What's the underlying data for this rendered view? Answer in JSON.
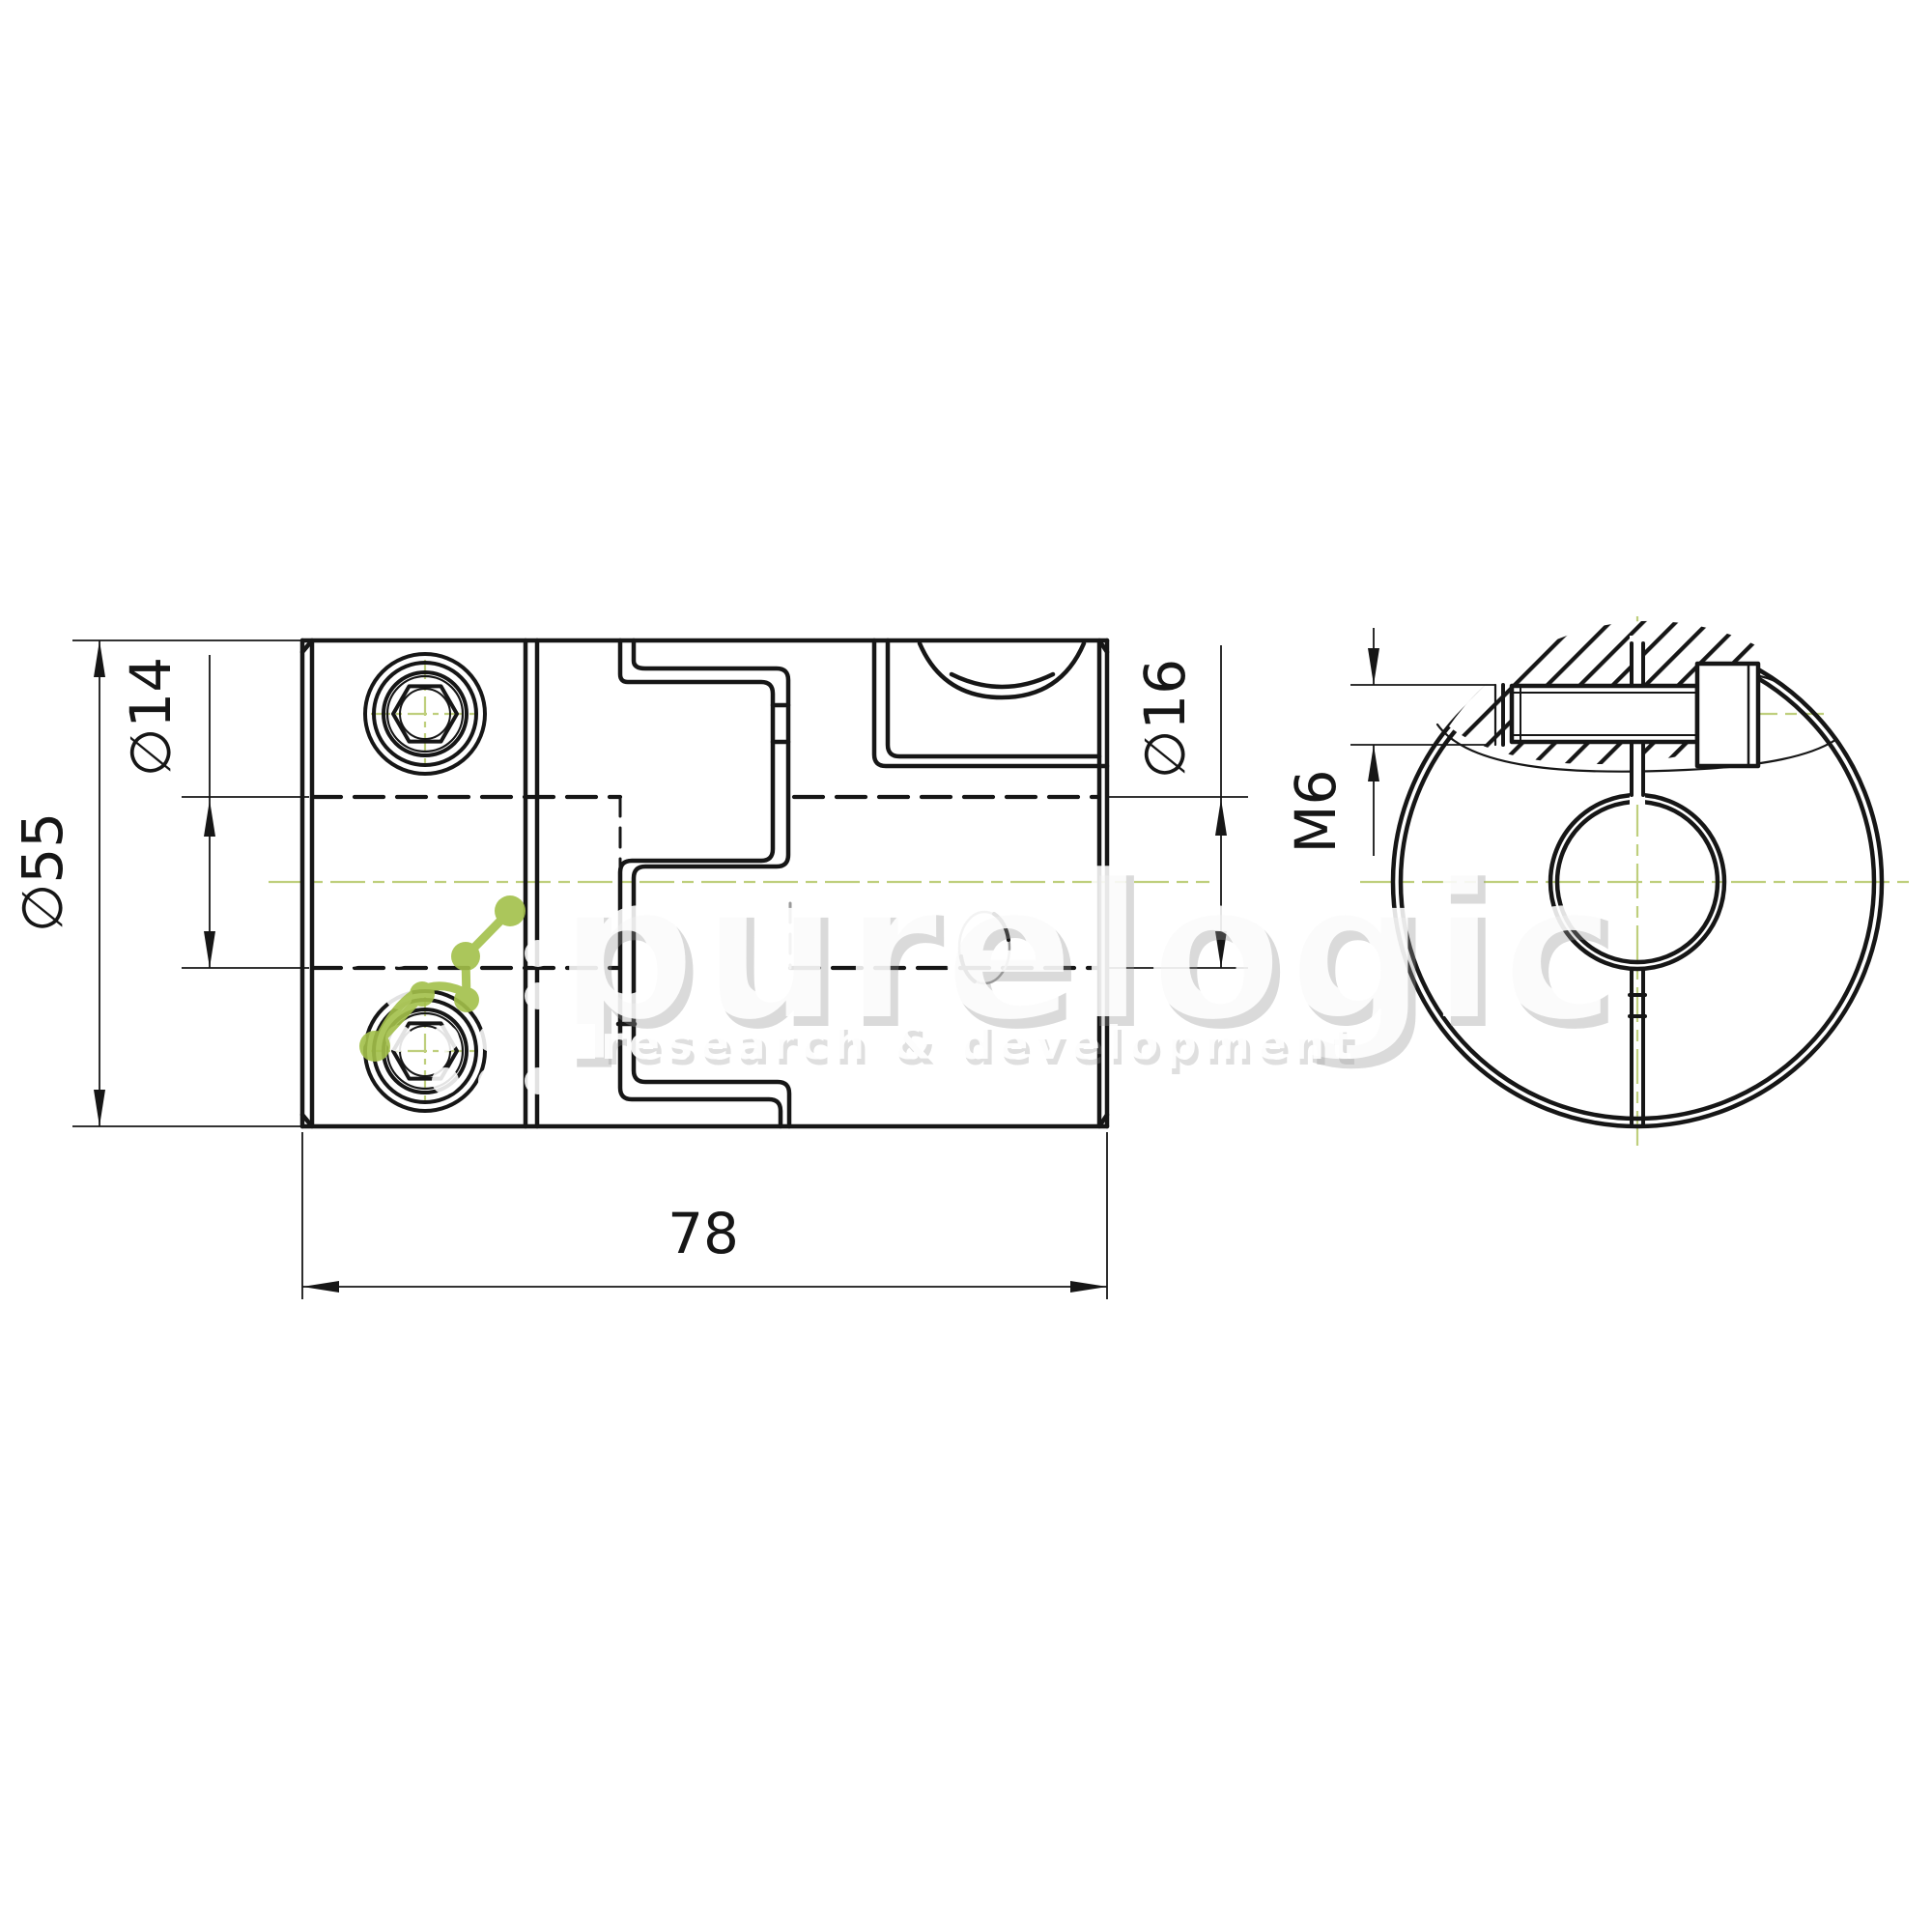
{
  "drawing": {
    "type": "technical-drawing",
    "views": [
      "side-section-view",
      "front-view"
    ],
    "background_color": "#ffffff",
    "line_color": "#161616",
    "centerline_color": "#bfcf7d",
    "dimensions": {
      "outer_diameter": "∅55",
      "bore_left": "∅14",
      "bore_right": "∅16",
      "overall_length": "78",
      "clamp_thread": "M6"
    },
    "watermark": {
      "brand": "purelogic",
      "subtitle": "research & development",
      "accent_color": "#a3c04a",
      "text_color": "#ffffff"
    }
  }
}
